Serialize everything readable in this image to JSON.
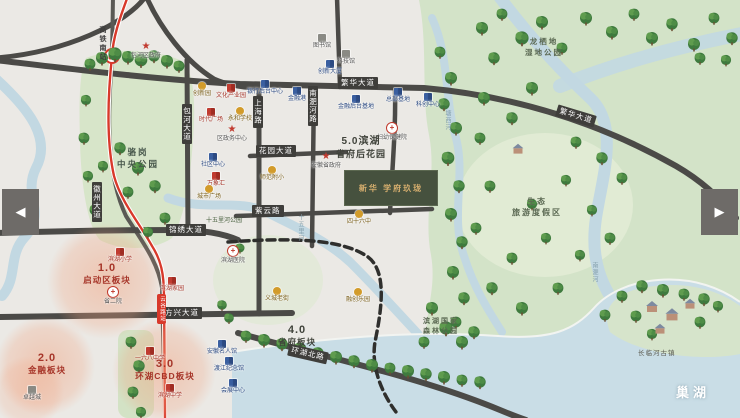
{
  "carousel": {
    "prev": "◀",
    "next": "▶"
  },
  "project": {
    "name": "新华 学府玖珑"
  },
  "lake_label": "巢湖",
  "colors": {
    "metro_red": "#d8392b",
    "water": "#c9dde6",
    "park_green": "#d7e5c9",
    "road": "#4b4a47",
    "accent_red": "#a63529"
  },
  "zones": [
    {
      "num": "1.0",
      "name": "启动区板块"
    },
    {
      "num": "2.0",
      "name": "金融板块"
    },
    {
      "num": "3.0",
      "name": "环湖CBD板块"
    },
    {
      "num": "4.0",
      "name": "省府板块"
    },
    {
      "num": "5.0滨湖",
      "name": "省府后花园"
    }
  ],
  "parks": {
    "central": {
      "line1": "骆岗",
      "line2": "中央公园"
    },
    "wetland": {
      "line1": "龙栖地",
      "line2": "湿地公园"
    },
    "eco": {
      "line1": "生态",
      "line2": "旅游度假区"
    },
    "forest": {
      "line1": "滨湖国家",
      "line2": "森林公园"
    },
    "ancient_town": "长临河古镇",
    "river_park": "十五里河公园"
  },
  "rivers": {
    "mid": "十五里河",
    "tangxi": "塘西河",
    "nanfei": "南淝河"
  },
  "roads": {
    "fanhua1": "繁华大道",
    "fanhua2": "繁华大道",
    "huayuan": "花园大道",
    "ziyun": "紫云路",
    "jinxiu": "锦绣大道",
    "fangxing": "方兴大道",
    "huanhu": "环湖北路",
    "huizhou": "徽州大道",
    "baohe": "包河大道",
    "shanghai": "上海路",
    "nanfeihe": "南淝河路"
  },
  "metro": {
    "station_top": "高铁南站",
    "station_mid": "云谷路站"
  },
  "pois": [
    {
      "label": "包河区政府"
    },
    {
      "label": "图书馆"
    },
    {
      "label": "科技馆"
    },
    {
      "label": "创新园"
    },
    {
      "label": "文化产业园"
    },
    {
      "label": "时代广场"
    },
    {
      "label": "永和学校"
    },
    {
      "label": "区政务中心"
    },
    {
      "label": "银行后台中心"
    },
    {
      "label": "金融港"
    },
    {
      "label": "创新大厦"
    },
    {
      "label": "金融后台基地"
    },
    {
      "label": "总部基地"
    },
    {
      "label": "科创中心"
    },
    {
      "label": "妇幼保健院"
    },
    {
      "label": "社区中心"
    },
    {
      "label": "万象汇"
    },
    {
      "label": "城市广场"
    },
    {
      "label": "师范附小"
    },
    {
      "label": "安徽省政府"
    },
    {
      "label": "四十六中"
    },
    {
      "label": "滨湖医院"
    },
    {
      "label": "滨湖小学"
    },
    {
      "label": "省二院"
    },
    {
      "label": "滨湖家园"
    },
    {
      "label": "一六八中学"
    },
    {
      "label": "滨湖中学"
    },
    {
      "label": "卓越城"
    },
    {
      "label": "安徽名人馆"
    },
    {
      "label": "渡江纪念馆"
    },
    {
      "label": "会展中心"
    },
    {
      "label": "义城老街"
    },
    {
      "label": "融创乐园"
    }
  ]
}
